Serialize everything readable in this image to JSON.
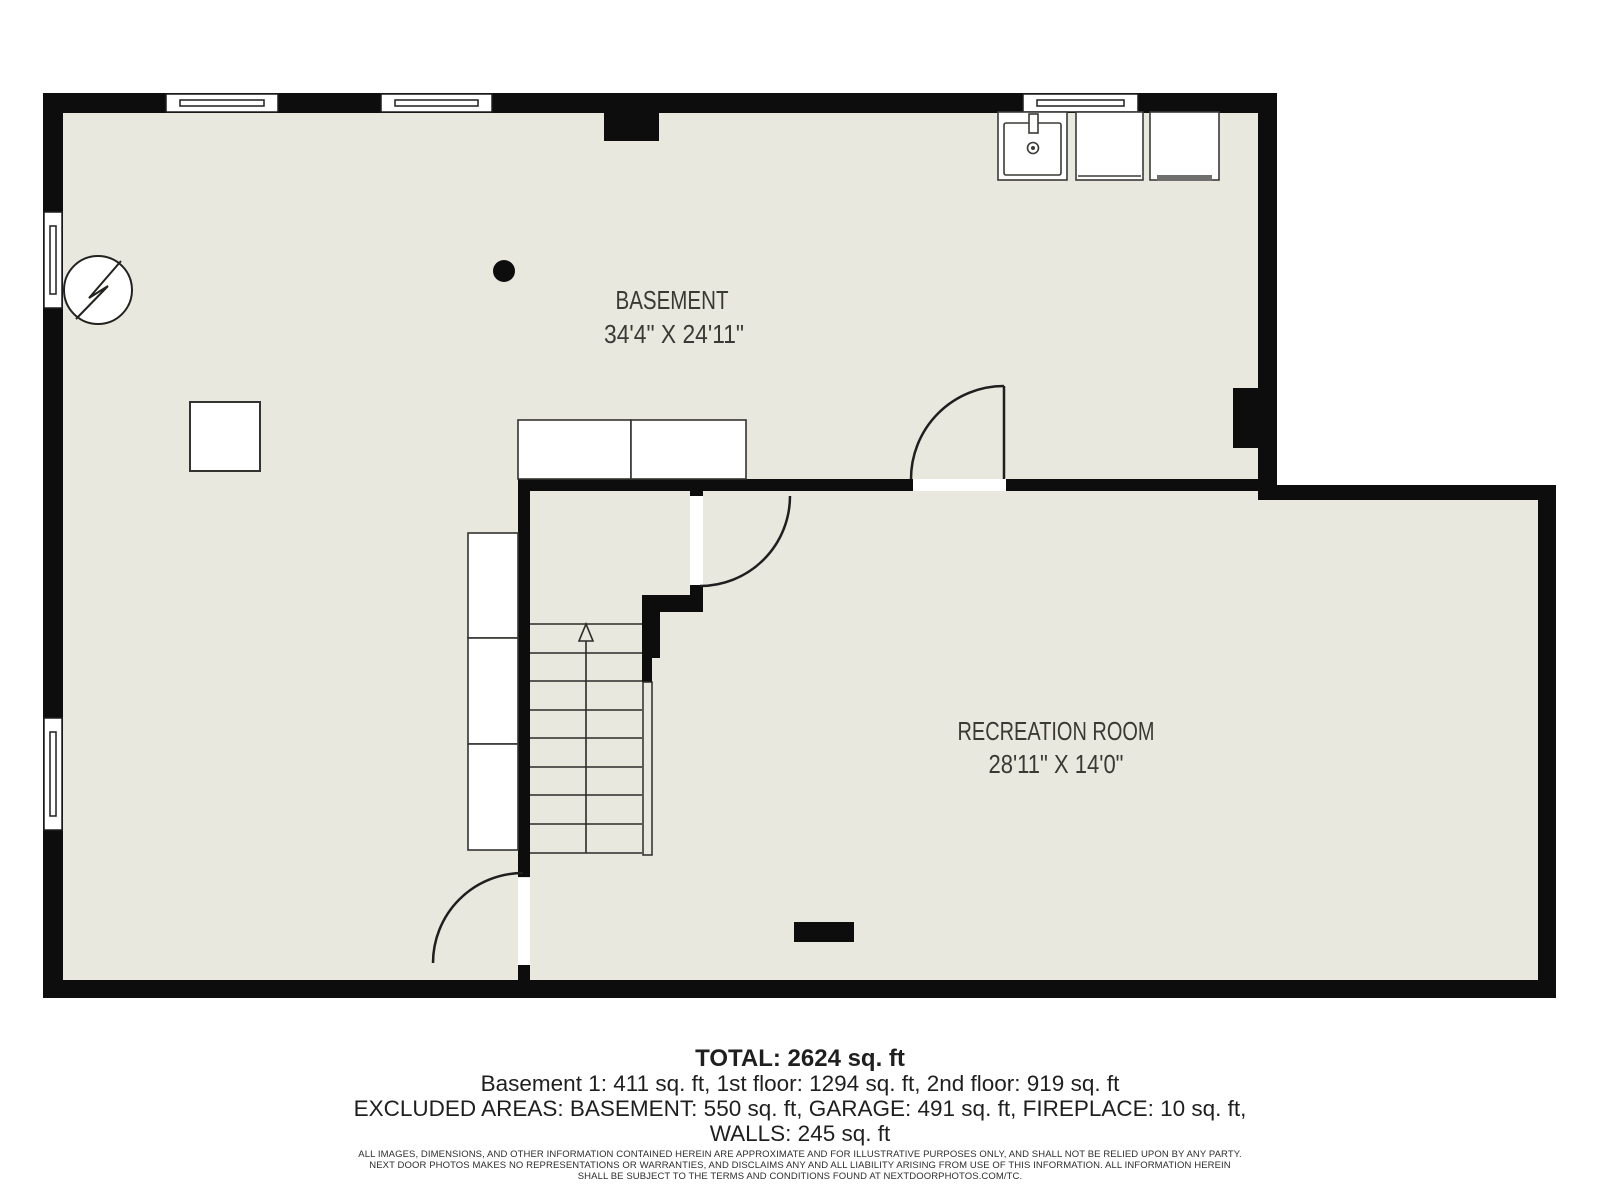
{
  "floor_plan": {
    "colors": {
      "floor_fill": "#e9e8df",
      "wall_fill": "#0d0d0d",
      "line_stroke": "#1f1f1f",
      "label_text": "#3a3935",
      "appliance_bar": "#6f6f6d"
    },
    "rooms": [
      {
        "name": "BASEMENT",
        "dimensions": "34'4\" X 24'11\""
      },
      {
        "name": "RECREATION ROOM",
        "dimensions": "28'11\" X 14'0\""
      }
    ],
    "fixtures": [
      "electrical-panel",
      "support-column",
      "furnace-pad",
      "counter",
      "storage-closets",
      "stairs-up",
      "utility-sink",
      "washer",
      "dryer",
      "fireplace",
      "windows",
      "doors"
    ],
    "stairs": {
      "direction": "up",
      "treads": 8
    }
  },
  "summary": {
    "total": "TOTAL: 2624 sq. ft",
    "floors": "Basement 1: 411 sq. ft, 1st floor: 1294 sq. ft, 2nd floor: 919 sq. ft",
    "excluded": "EXCLUDED AREAS: BASEMENT: 550 sq. ft, GARAGE: 491 sq. ft, FIREPLACE: 10 sq. ft,",
    "walls": "WALLS: 245 sq. ft"
  },
  "disclaimer": {
    "line1": "ALL IMAGES, DIMENSIONS, AND OTHER INFORMATION CONTAINED HEREIN ARE APPROXIMATE AND FOR ILLUSTRATIVE PURPOSES ONLY, AND SHALL NOT BE RELIED UPON BY ANY PARTY.",
    "line2": "NEXT DOOR PHOTOS MAKES NO REPRESENTATIONS OR WARRANTIES, AND DISCLAIMS ANY AND ALL LIABILITY ARISING FROM USE OF THIS INFORMATION. ALL INFORMATION HEREIN",
    "line3": "SHALL BE SUBJECT TO THE TERMS AND CONDITIONS FOUND AT NEXTDOORPHOTOS.COM/TC."
  }
}
